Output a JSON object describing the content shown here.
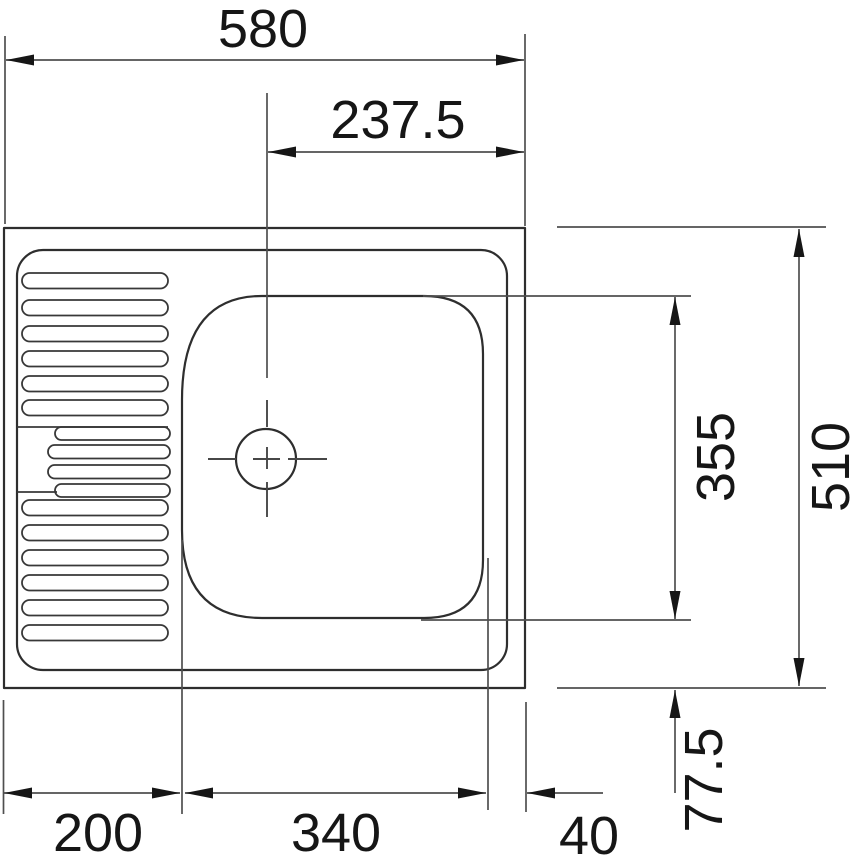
{
  "drawing": {
    "type": "technical-drawing",
    "subject": "kitchen sink top view with left drainboard and right bowl",
    "units_implied": "mm",
    "labels": {
      "overall_width": "580",
      "drain_offset_from_right": "237.5",
      "bowl_length": "355",
      "overall_depth": "510",
      "bowl_to_back_edge": "77.5",
      "drainer_width": "200",
      "bowl_width": "340",
      "side_margin": "40"
    },
    "colors": {
      "background": "#ffffff",
      "object_line": "#2e2e2e",
      "dimension_line": "#4f4f4f",
      "arrow": "#161616",
      "text": "#161616"
    }
  }
}
